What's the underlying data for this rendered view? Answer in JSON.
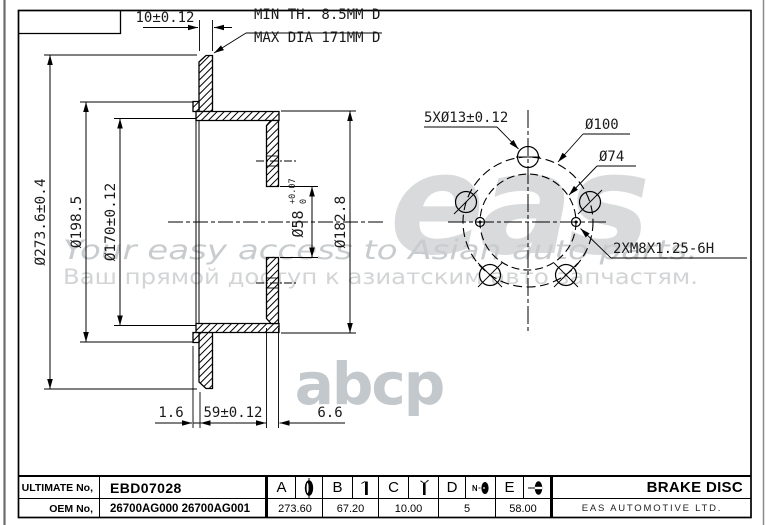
{
  "watermark": {
    "logo": "eas",
    "tagline_en": "Your easy access to Asian auto parts.",
    "tagline_ru": "Ваш прямой доступ к азиатским авто запчастям.",
    "logo2": "abcp"
  },
  "drawing": {
    "top_dim": "10±0.12",
    "note_line1": "MIN TH. 8.5MM D",
    "note_line2": "MAX DIA 171MM D",
    "left_dims": {
      "outer": "Ø273.6±0.4",
      "mid": "Ø198.5",
      "inner": "Ø170±0.12"
    },
    "right_dims": {
      "bore": "Ø58",
      "bore_tol_plus": "+0.07",
      "bore_tol_minus": "0",
      "hat": "Ø182.8"
    },
    "bottom_dims": {
      "lip": "1.6",
      "depth": "59±0.12",
      "flange": "6.6"
    },
    "front_view": {
      "holes": "5XØ13±0.12",
      "bcd": "Ø100",
      "inner_circle": "Ø74",
      "thread": "2XM8X1.25-6H"
    }
  },
  "title_block": {
    "row1_label": "ULTIMATE No,",
    "part_no": "EBD07028",
    "row2_label": "OEM No,",
    "oem_no": "26700AG000  26700AG001",
    "dims": [
      {
        "letter": "A",
        "value": "273.60"
      },
      {
        "letter": "B",
        "value": "67.20"
      },
      {
        "letter": "C",
        "value": "10.00"
      },
      {
        "letter": "D",
        "value": "5"
      },
      {
        "letter": "E",
        "value": "58.00"
      }
    ],
    "product": "BRAKE DISC",
    "company": "EAS AUTOMOTIVE LTD."
  }
}
